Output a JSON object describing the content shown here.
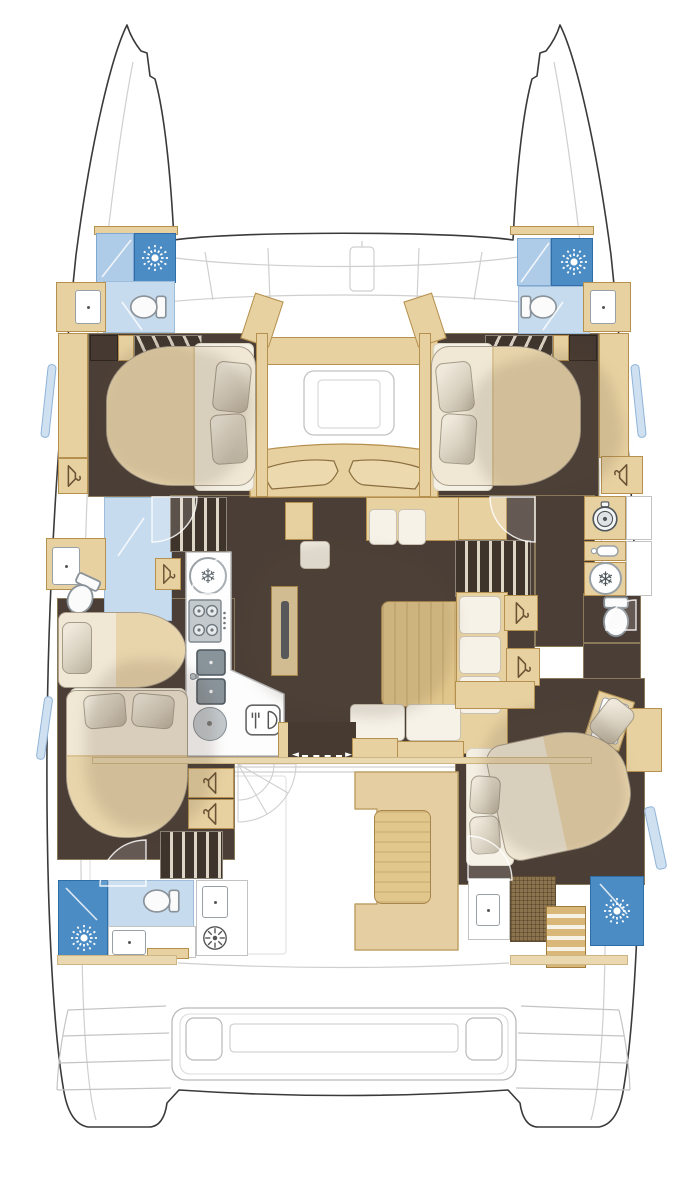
{
  "document": {
    "type": "floor-plan",
    "subject": "catamaran-yacht-interior-deck-plan-top-view",
    "visible_text_items": []
  },
  "palette": {
    "hull_outline": "#3a3a3a",
    "deck_line": "#c9c9c9",
    "wood_light": "#e7d1a1",
    "wood_trim": "#b5904e",
    "wood_table": "#e2c78c",
    "floor_dark": "#4a3e36",
    "dark_cabinet": "#463931",
    "linen_white": "#f5f0e4",
    "mattress_cream": "#f0e8d5",
    "blanket_tan": "#e8d3a8",
    "pillow_gray": "#dbd4c5",
    "shower_blue": "#4b8cc4",
    "glass_blue": "#aecbe7",
    "bath_floor_blue": "#c7dbee",
    "steel_gray": "#89939a",
    "mat_brown": "#8b744e",
    "white": "#ffffff"
  },
  "icons": {
    "snowflake_glyph": "❄",
    "arrow_left_glyph": "◄",
    "arrow_right_glyph": "►",
    "shower_head": "sunburst-spray",
    "toilet": "toilet-top-view",
    "clothes_hanger": "hanger",
    "stove": "four-burner-hob",
    "double_sink": "double-basin-sink",
    "round_basin": "round-basin",
    "dishwasher": "dishwasher-fork-plate",
    "washing_machine": "front-load-washer",
    "freezer": "snowflake-circle",
    "fridge": "snowflake-circle",
    "vent_fan": "spoked-fan",
    "water_heater": "bottle"
  },
  "fixture_counts": {
    "shower_heads": 4,
    "toilets": 5,
    "hanger_lockers": 7,
    "beds": 5,
    "sinks": 8,
    "stairs": 4
  }
}
